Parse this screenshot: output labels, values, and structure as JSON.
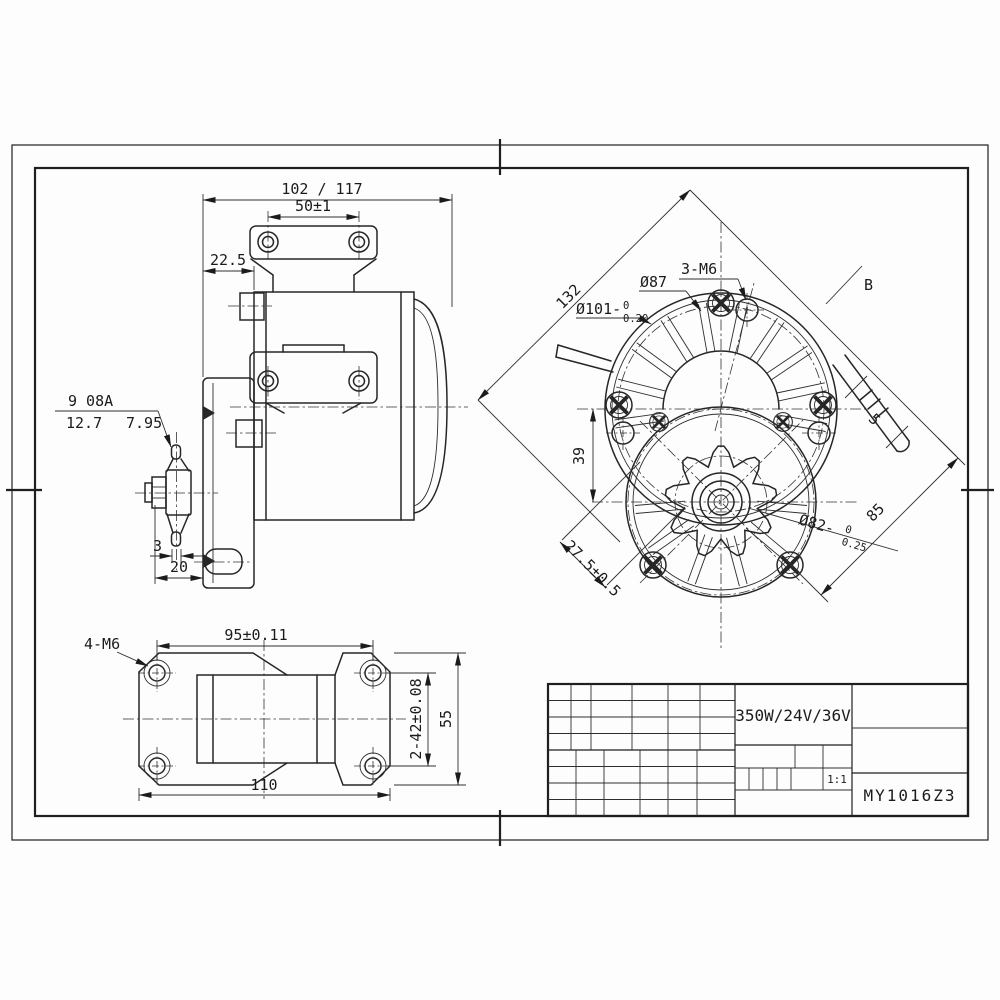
{
  "drawing": {
    "side_view": {
      "dim_overall": "102 / 117",
      "dim_bracket_holes": "50±1",
      "dim_face_offset": "22.5",
      "sprocket_note": {
        "teeth_chain": "9 08A",
        "pitch": "12.7",
        "roller": "7.95"
      },
      "dim_plate_thickness": "3",
      "dim_hub_width": "20"
    },
    "end_view": {
      "dim_diagonal_body": "132",
      "dim_spigot": {
        "text": "Ø101-",
        "upper": "0",
        "lower": "0.20"
      },
      "dim_bolt_circle": "Ø87",
      "note_threads": "3-M6",
      "view_label": "B",
      "dim_cable": "5",
      "dim_axis_offset": "39",
      "dim_screw_offset": "27.5±0.5",
      "dim_pilot": {
        "text": "Ø82-",
        "upper": "0",
        "lower": "0.25"
      },
      "dim_diagonal_gear": "85"
    },
    "bottom_view": {
      "note_threads": "4-M6",
      "dim_hole_span_x": "95±0.11",
      "dim_overall_width": "110",
      "dim_hole_span_y": "2-42±0.08",
      "dim_overall_depth": "55"
    }
  },
  "title_block": {
    "spec": "350W/24V/36V",
    "scale": "1:1",
    "model": "MY1016Z3"
  }
}
